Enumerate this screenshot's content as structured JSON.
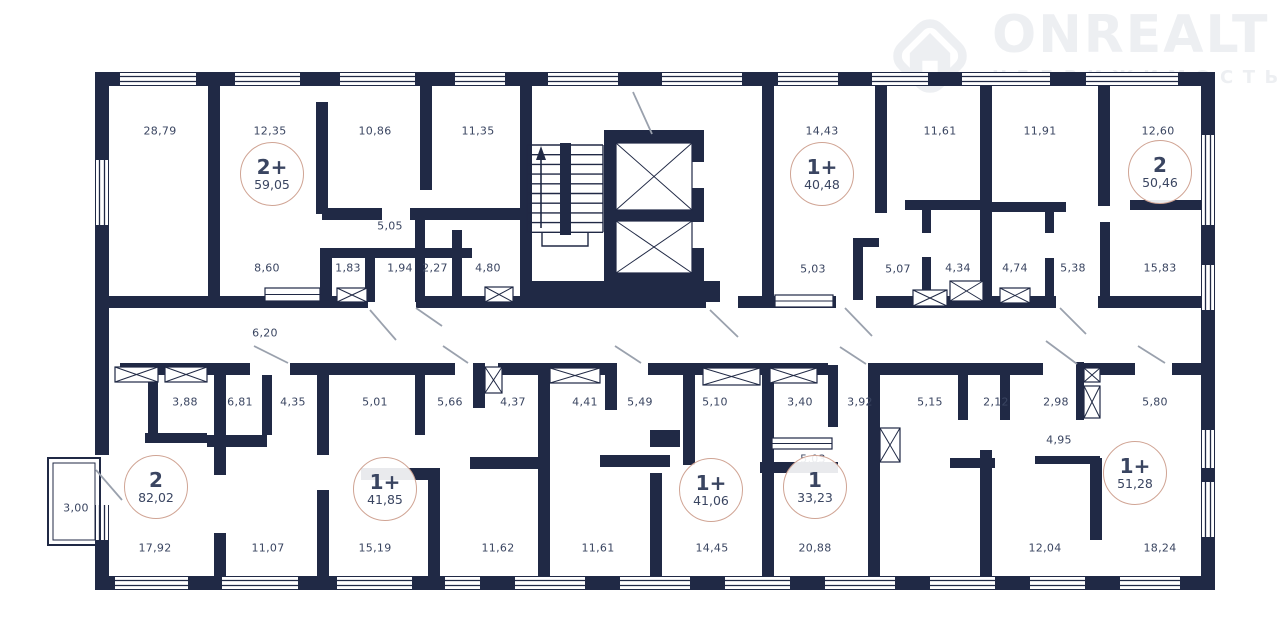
{
  "logo": {
    "brand": "ONREALT",
    "subtitle": "НЕДВИЖИМОСТЬ",
    "icon": "house-diamond-icon"
  },
  "colors": {
    "wall": "#202945",
    "label_text": "#3a4561",
    "badge_border": "#d0a494",
    "door_line": "#9aa1ad",
    "logo": "#edeff2"
  },
  "apartments": [
    {
      "type": "2+",
      "area": "59,05",
      "x": 272,
      "y": 174
    },
    {
      "type": "1+",
      "area": "40,48",
      "x": 822,
      "y": 174
    },
    {
      "type": "2",
      "area": "50,46",
      "x": 1160,
      "y": 172
    },
    {
      "type": "2",
      "area": "82,02",
      "x": 156,
      "y": 487
    },
    {
      "type": "1+",
      "area": "41,85",
      "x": 385,
      "y": 489
    },
    {
      "type": "1+",
      "area": "41,06",
      "x": 711,
      "y": 490
    },
    {
      "type": "1",
      "area": "33,23",
      "x": 815,
      "y": 487
    },
    {
      "type": "1+",
      "area": "51,28",
      "x": 1135,
      "y": 473
    }
  ],
  "room_labels": [
    {
      "text": "28,79",
      "x": 160,
      "y": 131
    },
    {
      "text": "12,35",
      "x": 270,
      "y": 131
    },
    {
      "text": "10,86",
      "x": 375,
      "y": 131
    },
    {
      "text": "11,35",
      "x": 478,
      "y": 131
    },
    {
      "text": "14,43",
      "x": 822,
      "y": 131
    },
    {
      "text": "11,61",
      "x": 940,
      "y": 131
    },
    {
      "text": "11,91",
      "x": 1040,
      "y": 131
    },
    {
      "text": "12,60",
      "x": 1158,
      "y": 131
    },
    {
      "text": "5,05",
      "x": 390,
      "y": 226
    },
    {
      "text": "8,60",
      "x": 267,
      "y": 268
    },
    {
      "text": "1,83",
      "x": 348,
      "y": 268
    },
    {
      "text": "1,94",
      "x": 400,
      "y": 268
    },
    {
      "text": "2,27",
      "x": 435,
      "y": 268
    },
    {
      "text": "4,80",
      "x": 488,
      "y": 268
    },
    {
      "text": "5,03",
      "x": 813,
      "y": 269
    },
    {
      "text": "5,07",
      "x": 898,
      "y": 269
    },
    {
      "text": "4,34",
      "x": 958,
      "y": 268
    },
    {
      "text": "4,74",
      "x": 1015,
      "y": 268
    },
    {
      "text": "5,38",
      "x": 1073,
      "y": 268
    },
    {
      "text": "15,83",
      "x": 1160,
      "y": 268
    },
    {
      "text": "6,20",
      "x": 265,
      "y": 333
    },
    {
      "text": "3,88",
      "x": 185,
      "y": 402
    },
    {
      "text": "6,81",
      "x": 240,
      "y": 402
    },
    {
      "text": "4,35",
      "x": 293,
      "y": 402
    },
    {
      "text": "5,01",
      "x": 375,
      "y": 402
    },
    {
      "text": "5,66",
      "x": 450,
      "y": 402
    },
    {
      "text": "4,37",
      "x": 513,
      "y": 402
    },
    {
      "text": "4,41",
      "x": 585,
      "y": 402
    },
    {
      "text": "5,49",
      "x": 640,
      "y": 402
    },
    {
      "text": "5,10",
      "x": 715,
      "y": 402
    },
    {
      "text": "3,40",
      "x": 800,
      "y": 402
    },
    {
      "text": "3,92",
      "x": 860,
      "y": 402
    },
    {
      "text": "5,15",
      "x": 930,
      "y": 402
    },
    {
      "text": "2,12",
      "x": 996,
      "y": 402
    },
    {
      "text": "2,98",
      "x": 1056,
      "y": 402
    },
    {
      "text": "5,80",
      "x": 1155,
      "y": 402
    },
    {
      "text": "4,95",
      "x": 1059,
      "y": 440
    },
    {
      "text": "5,03",
      "x": 813,
      "y": 459
    },
    {
      "text": "3,00",
      "x": 76,
      "y": 508
    },
    {
      "text": "17,92",
      "x": 155,
      "y": 548
    },
    {
      "text": "11,07",
      "x": 268,
      "y": 548
    },
    {
      "text": "15,19",
      "x": 375,
      "y": 548
    },
    {
      "text": "11,62",
      "x": 498,
      "y": 548
    },
    {
      "text": "11,61",
      "x": 598,
      "y": 548
    },
    {
      "text": "14,45",
      "x": 712,
      "y": 548
    },
    {
      "text": "20,88",
      "x": 815,
      "y": 548
    },
    {
      "text": "12,04",
      "x": 1045,
      "y": 548
    },
    {
      "text": "18,24",
      "x": 1160,
      "y": 548
    }
  ]
}
